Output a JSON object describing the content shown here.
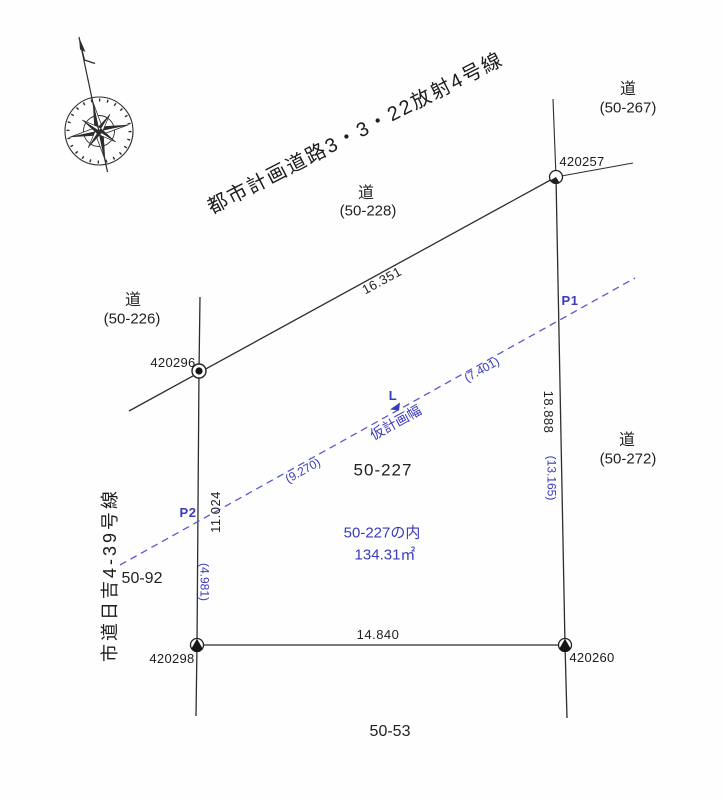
{
  "title": "都市計画道路3・3・22放射4号線",
  "roads": {
    "r228": {
      "kanji": "道",
      "code": "(50-228)"
    },
    "r267": {
      "kanji": "道",
      "code": "(50-267)"
    },
    "r226": {
      "kanji": "道",
      "code": "(50-226)"
    },
    "r272": {
      "kanji": "道",
      "code": "(50-272)"
    }
  },
  "city_road": "市道日吉4-39号線",
  "lots": {
    "main": "50-227",
    "west": "50-92",
    "south": "50-53"
  },
  "parcel": {
    "name": "50-227の内",
    "area": "134.31㎡"
  },
  "points": {
    "p420257": "420257",
    "p420296": "420296",
    "p420298": "420298",
    "p420260": "420260"
  },
  "dimensions": {
    "north": "16.351",
    "south": "14.840",
    "west": "11.024",
    "east": "18.888"
  },
  "plan_dimensions": {
    "upper": "(7.401)",
    "lower": "(9.270)",
    "west": "(4.981)",
    "east": "(13.165)"
  },
  "plan_line": {
    "p1": "P1",
    "p2": "P2",
    "l_label": "L",
    "width_label": "仮計画幅"
  },
  "colors": {
    "plan_blue": "#3a3abc",
    "dashed_blue": "#5a5ace",
    "line_black": "#2d2d2d"
  }
}
